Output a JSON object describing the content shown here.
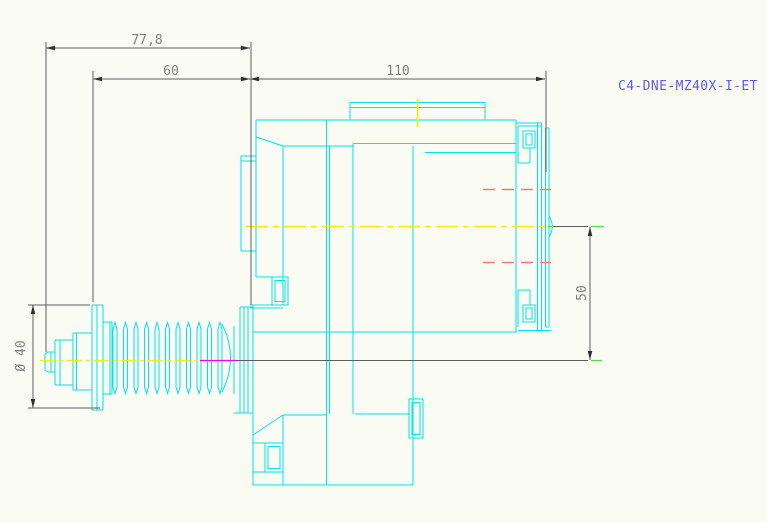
{
  "part_label": "C4-DNE-MZ40X-I-ET",
  "dimensions": {
    "overall_length": "77,8",
    "thread_length": "60",
    "body_length": "110",
    "axis_offset": "50",
    "thread_diameter": "Ø 40"
  },
  "colors": {
    "geometry": "#00e3e8",
    "dim_line": "#5d5d5d",
    "dim_arrow": "#2e2e2e",
    "dim_text": "#7f7f7f",
    "centerline_yellow": "#efef0a",
    "hidden_red": "#ee7b7b",
    "magenta": "#ee00ee",
    "green": "#58d858",
    "label_blue": "#5a5af0",
    "background": "#fafcf3"
  }
}
